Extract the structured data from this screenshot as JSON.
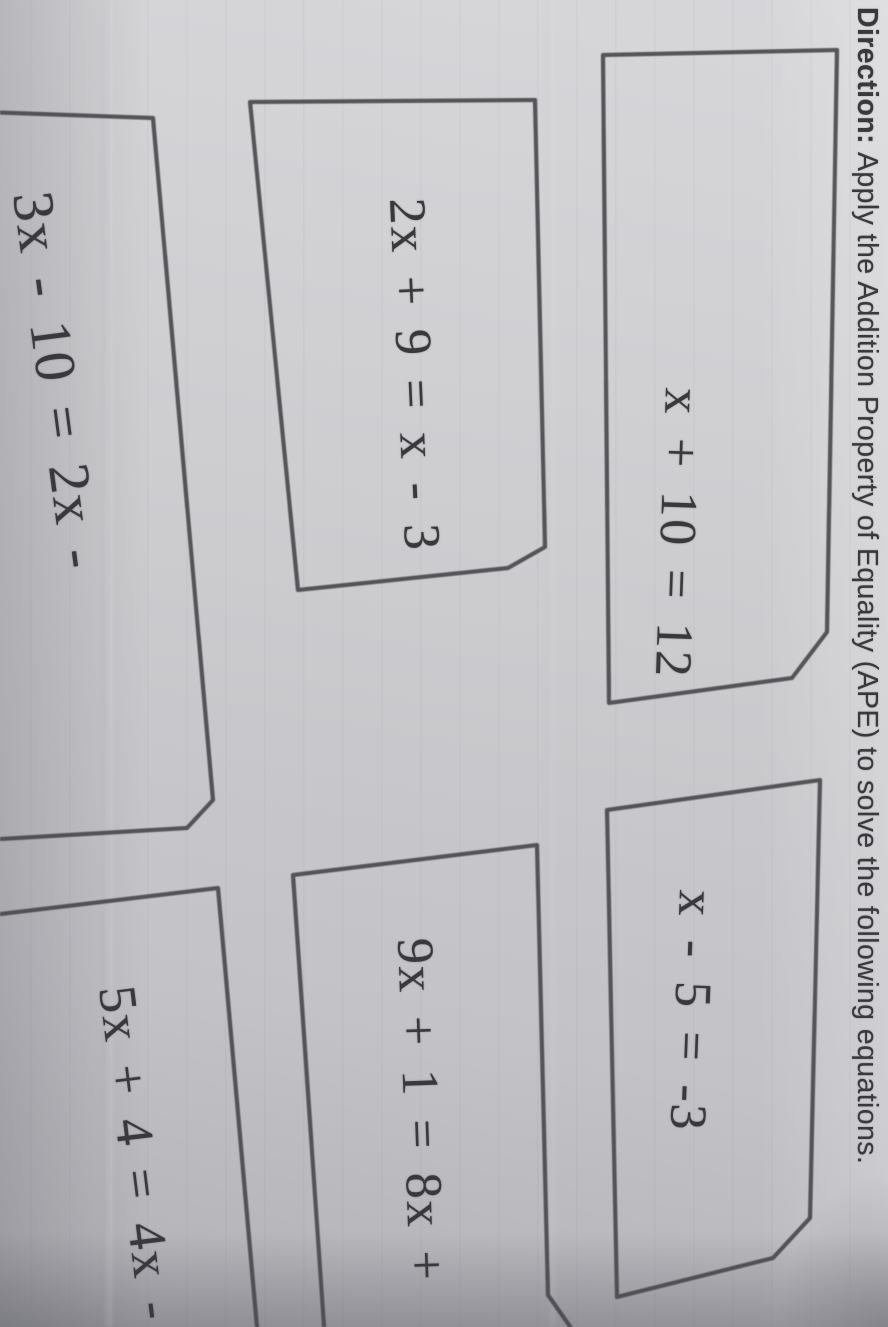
{
  "colors": {
    "paper": "#cccccf",
    "paper-light": "#d7d7da",
    "paper-dark": "#b0b0b5",
    "ink": "#38383d",
    "border": "#47474b"
  },
  "title": {
    "label": "Direction:",
    "text": "Apply the Addition Property of Equality (APE) to solve the following equations."
  },
  "cards": [
    {
      "equation": "x + 10 = 12"
    },
    {
      "equation": "x - 5 = -3"
    },
    {
      "equation": "2x + 9 = x - 3"
    },
    {
      "equation": "9x + 1 = 8x +"
    },
    {
      "equation": "3x - 10 = 2x -"
    },
    {
      "equation": "5x + 4 = 4x -"
    }
  ]
}
